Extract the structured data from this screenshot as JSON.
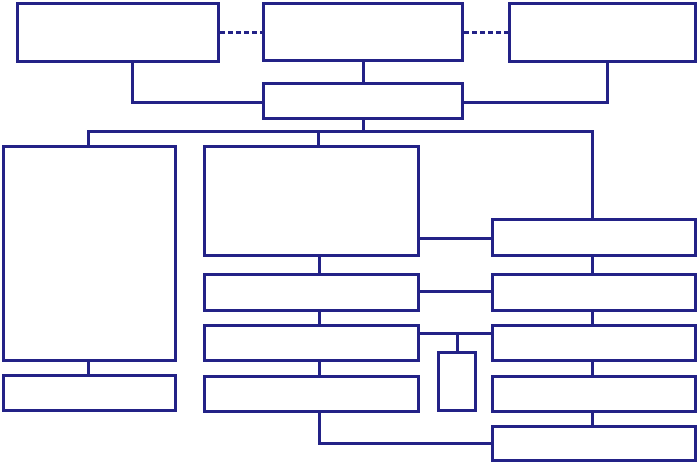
{
  "diagram": {
    "type": "flowchart-block-diagram",
    "background_color": "#ffffff",
    "line_color": "#232287",
    "line_width": 3,
    "dash_on": 5,
    "dash_off": 3,
    "nodes": [
      {
        "id": "top-left-box",
        "label": "",
        "x": 16,
        "y": 2,
        "w": 204,
        "h": 61
      },
      {
        "id": "top-middle-box",
        "label": "",
        "x": 262,
        "y": 2,
        "w": 202,
        "h": 60
      },
      {
        "id": "top-right-box",
        "label": "",
        "x": 508,
        "y": 2,
        "w": 189,
        "h": 61
      },
      {
        "id": "hub-box",
        "label": "",
        "x": 262,
        "y": 82,
        "w": 202,
        "h": 38
      },
      {
        "id": "left-tall-box",
        "label": "",
        "x": 2,
        "y": 145,
        "w": 175,
        "h": 217
      },
      {
        "id": "left-small-box",
        "label": "",
        "x": 2,
        "y": 374,
        "w": 175,
        "h": 38
      },
      {
        "id": "mid-large-box",
        "label": "",
        "x": 203,
        "y": 145,
        "w": 217,
        "h": 112
      },
      {
        "id": "mid-row-1-box",
        "label": "",
        "x": 203,
        "y": 273,
        "w": 217,
        "h": 39
      },
      {
        "id": "mid-row-2-box",
        "label": "",
        "x": 203,
        "y": 324,
        "w": 217,
        "h": 38
      },
      {
        "id": "mid-row-3-box",
        "label": "",
        "x": 203,
        "y": 375,
        "w": 217,
        "h": 38
      },
      {
        "id": "small-vertical-box",
        "label": "",
        "x": 437,
        "y": 351,
        "w": 40,
        "h": 61
      },
      {
        "id": "right-row-1-box",
        "label": "",
        "x": 491,
        "y": 218,
        "w": 206,
        "h": 39
      },
      {
        "id": "right-row-2-box",
        "label": "",
        "x": 491,
        "y": 273,
        "w": 206,
        "h": 39
      },
      {
        "id": "right-row-3-box",
        "label": "",
        "x": 491,
        "y": 324,
        "w": 206,
        "h": 38
      },
      {
        "id": "right-row-4-box",
        "label": "",
        "x": 491,
        "y": 375,
        "w": 206,
        "h": 38
      },
      {
        "id": "right-row-5-box",
        "label": "",
        "x": 491,
        "y": 425,
        "w": 206,
        "h": 37
      }
    ],
    "edges": [
      {
        "id": "dashed-link-left",
        "style": "dashed",
        "points": [
          [
            220,
            32
          ],
          [
            262,
            32
          ]
        ]
      },
      {
        "id": "dashed-link-right",
        "style": "dashed",
        "points": [
          [
            464,
            32
          ],
          [
            508,
            32
          ]
        ]
      },
      {
        "id": "topleft-to-hub",
        "style": "solid",
        "points": [
          [
            132,
            63
          ],
          [
            132,
            102
          ],
          [
            262,
            102
          ]
        ]
      },
      {
        "id": "topright-to-hub",
        "style": "solid",
        "points": [
          [
            607,
            63
          ],
          [
            607,
            102
          ],
          [
            464,
            102
          ]
        ]
      },
      {
        "id": "topmiddle-to-hub",
        "style": "solid",
        "points": [
          [
            363,
            62
          ],
          [
            363,
            82
          ]
        ]
      },
      {
        "id": "hub-to-bus",
        "style": "solid",
        "points": [
          [
            363,
            119
          ],
          [
            363,
            131
          ]
        ]
      },
      {
        "id": "distribution-bus",
        "style": "solid",
        "points": [
          [
            88,
            131
          ],
          [
            592,
            131
          ]
        ]
      },
      {
        "id": "bus-drop-left",
        "style": "solid",
        "points": [
          [
            88,
            131
          ],
          [
            88,
            146
          ]
        ]
      },
      {
        "id": "bus-drop-middle",
        "style": "solid",
        "points": [
          [
            318,
            131
          ],
          [
            318,
            146
          ]
        ]
      },
      {
        "id": "bus-drop-right",
        "style": "solid",
        "points": [
          [
            592,
            131
          ],
          [
            592,
            219
          ]
        ]
      },
      {
        "id": "midlarge-to-right1",
        "style": "solid",
        "points": [
          [
            420,
            238
          ],
          [
            491,
            238
          ]
        ]
      },
      {
        "id": "mid1-to-right2",
        "style": "solid",
        "points": [
          [
            420,
            291
          ],
          [
            491,
            291
          ]
        ]
      },
      {
        "id": "mid2-to-right3",
        "style": "solid",
        "points": [
          [
            420,
            333
          ],
          [
            491,
            333
          ]
        ]
      },
      {
        "id": "branch-to-smallbox",
        "style": "solid",
        "points": [
          [
            457,
            333
          ],
          [
            457,
            352
          ]
        ]
      },
      {
        "id": "mid-chain-1",
        "style": "solid",
        "points": [
          [
            319,
            257
          ],
          [
            319,
            273
          ]
        ]
      },
      {
        "id": "mid-chain-2",
        "style": "solid",
        "points": [
          [
            319,
            312
          ],
          [
            319,
            324
          ]
        ]
      },
      {
        "id": "mid-chain-3",
        "style": "solid",
        "points": [
          [
            319,
            362
          ],
          [
            319,
            375
          ]
        ]
      },
      {
        "id": "mid3-to-right5",
        "style": "solid",
        "points": [
          [
            319,
            413
          ],
          [
            319,
            443
          ],
          [
            491,
            443
          ]
        ]
      },
      {
        "id": "right-chain-1",
        "style": "solid",
        "points": [
          [
            592,
            257
          ],
          [
            592,
            273
          ]
        ]
      },
      {
        "id": "right-chain-2",
        "style": "solid",
        "points": [
          [
            592,
            312
          ],
          [
            592,
            324
          ]
        ]
      },
      {
        "id": "right-chain-3",
        "style": "solid",
        "points": [
          [
            592,
            362
          ],
          [
            592,
            375
          ]
        ]
      },
      {
        "id": "right-chain-4",
        "style": "solid",
        "points": [
          [
            592,
            413
          ],
          [
            592,
            425
          ]
        ]
      },
      {
        "id": "lefttall-to-leftsmall",
        "style": "solid",
        "points": [
          [
            88,
            362
          ],
          [
            88,
            374
          ]
        ]
      }
    ]
  }
}
